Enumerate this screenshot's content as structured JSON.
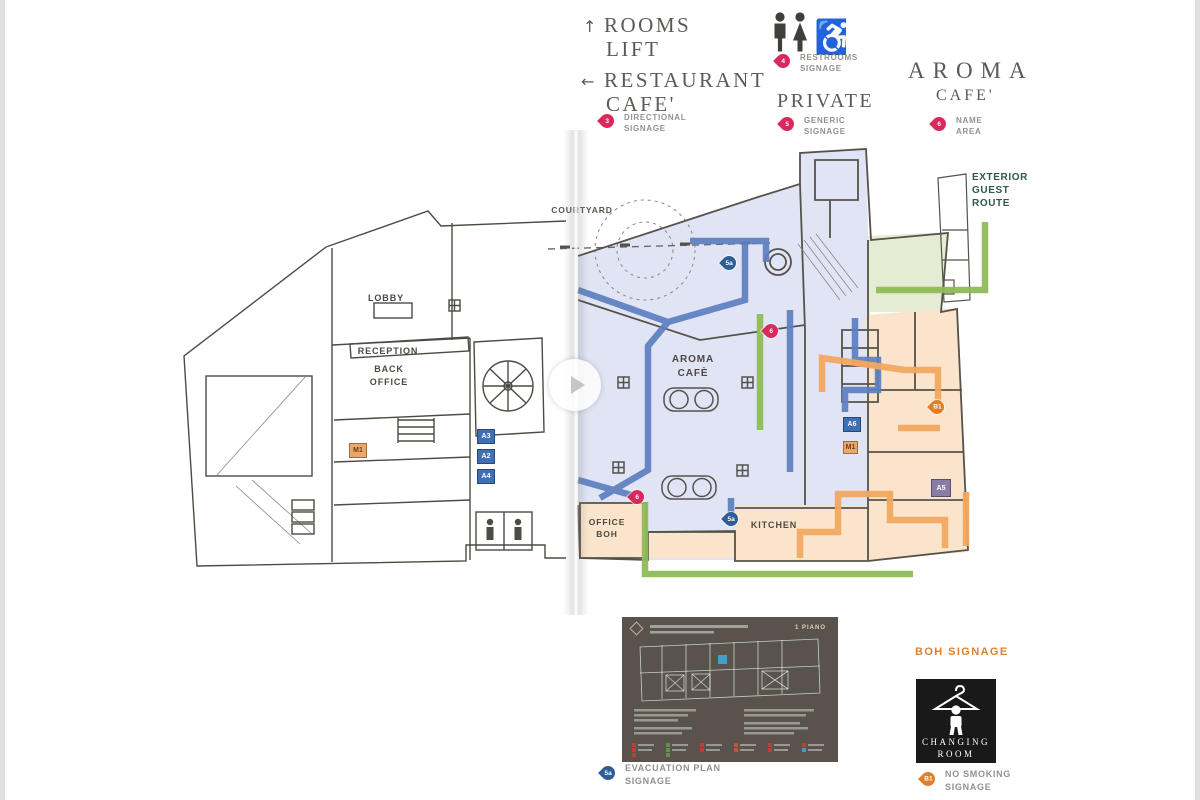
{
  "legend": {
    "rooms_lift": {
      "arrow": "↑",
      "line1": "ROOMS",
      "line2": "LIFT"
    },
    "restaurant": {
      "arrow": "←",
      "line1": "RESTAURANT",
      "line2": "CAFE'",
      "pin": "3",
      "cap1": "DIRECTIONAL",
      "cap2": "SIGNAGE"
    },
    "restrooms": {
      "pin": "4",
      "cap1": "RESTROOMS",
      "cap2": "SIGNAGE"
    },
    "private": {
      "title": "PRIVATE",
      "pin": "5",
      "cap1": "GENERIC",
      "cap2": "SIGNAGE"
    },
    "aroma_cafe": {
      "line1": "AROMA",
      "line2": "CAFE'",
      "pin": "6",
      "cap1": "NAME",
      "cap2": "AREA"
    }
  },
  "route_labels": {
    "exterior1": "EXTERIOR",
    "exterior2": "GUEST",
    "exterior3": "ROUTE",
    "boh": "BOH SIGNAGE"
  },
  "plan": {
    "lobby": "LOBBY",
    "reception": "RECEPTION",
    "back1": "BACK",
    "back2": "OFFICE",
    "courtyard": "COURTYARD",
    "aroma1": "AROMA",
    "aroma2": "CAFÈ",
    "kitchen": "KITCHEN",
    "officeboh1": "OFFICE",
    "officeboh2": "BOH",
    "pins": {
      "court5a": "5a",
      "court6": "6",
      "office6": "6",
      "kitchen5a": "5a",
      "bohB1": "B1"
    },
    "tags": {
      "m1l": "M1",
      "a3": "A3",
      "a2": "A2",
      "a4": "A4",
      "a6": "A6",
      "m1r": "M1",
      "a5": "A5"
    }
  },
  "footer": {
    "evac_pin": "5a",
    "evac1": "EVACUATION PLAN",
    "evac2": "SIGNAGE",
    "smoke_pin": "B1",
    "smoke1": "NO SMOKING",
    "smoke2": "SIGNAGE"
  },
  "changing_sign": {
    "line1": "CHANGING",
    "line2": "ROOM"
  },
  "evac_panel": {
    "floor": "1 PIANO"
  },
  "colors": {
    "pin_pink": "#d82a5c",
    "pin_navy": "#2e5e95",
    "pin_orange": "#df7f2c",
    "route_blue": "#5d80c1",
    "route_green": "#8fbc55",
    "route_orange": "#f2a85f",
    "fill_guest": "#dfe3f4",
    "fill_boh": "#fbe4cc",
    "fill_exterior": "#e4ecd4",
    "boh_text": "#d9832f",
    "exterior_text": "#30584d"
  }
}
